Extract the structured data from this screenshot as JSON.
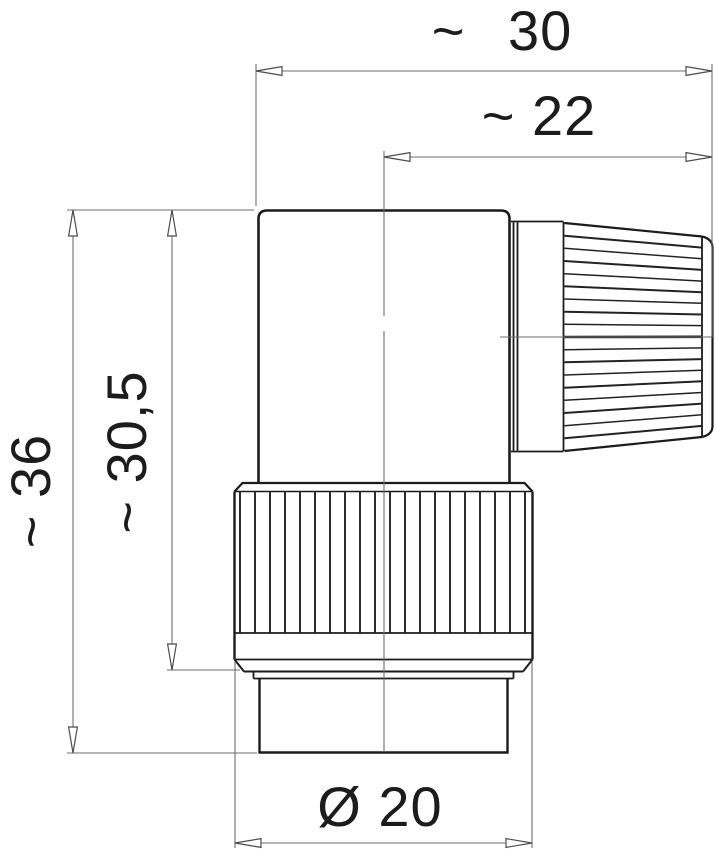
{
  "drawing": {
    "title": "Right-angle circular connector — dimensional side view",
    "background_color": "#ffffff",
    "outline_color": "#1b1b1b",
    "dimension_line_color": "#6e6e6e",
    "text_color": "#1c1c1c",
    "dimensions": {
      "overall_width": {
        "label": "~ 30",
        "value": 30,
        "approx": true
      },
      "axis_to_cable_end": {
        "label": "~ 22",
        "value": 22,
        "approx": true
      },
      "overall_height": {
        "label": "~ 36",
        "value": 36,
        "approx": true
      },
      "height_to_coupling": {
        "label": "~ 30,5",
        "value": 30.5,
        "approx": true
      },
      "coupling_diameter": {
        "label": "Ø 20",
        "value": 20,
        "diameter": true
      }
    }
  }
}
